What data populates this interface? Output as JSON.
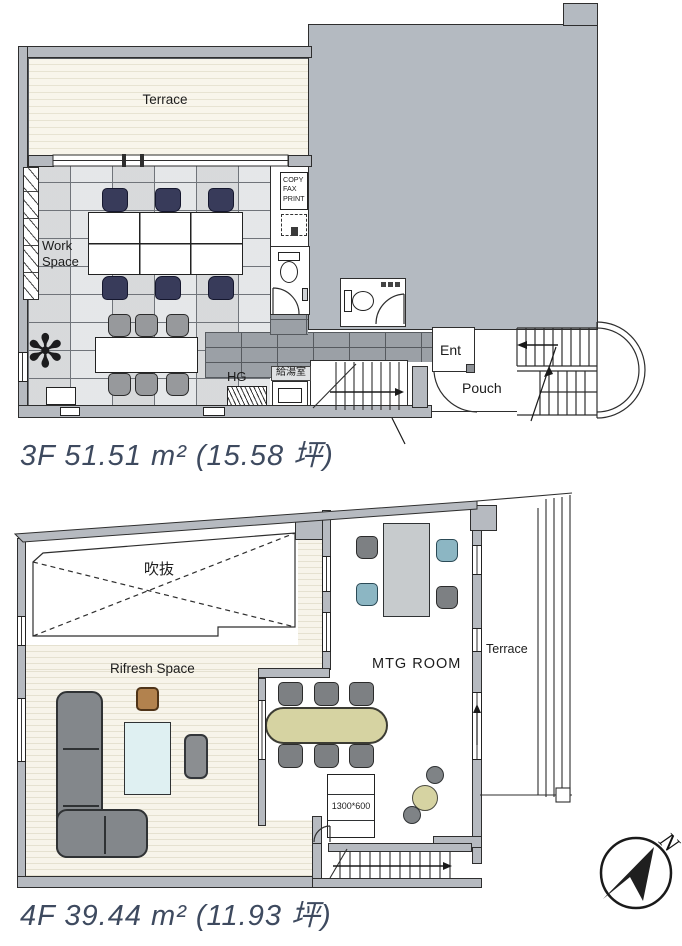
{
  "floor_3f": {
    "area_label": "3F 51.51 m² (15.58 坪)",
    "terrace_label": "Terrace",
    "work_space_label": "Work\nSpace",
    "copy_label": "COPY\nFAX\nPRINT",
    "hg_label": "HG",
    "kitchenette_label": "給湯室",
    "entrance_label": "Ent",
    "porch_label": "Pouch"
  },
  "floor_4f": {
    "area_label": "4F 39.44 m² (11.93 坪)",
    "void_label": "吹抜",
    "refresh_space_label": "Rifresh Space",
    "meeting_room_label": "MTG ROOM",
    "terrace_label": "Terrace",
    "shelf_size_label": "1300*600"
  },
  "compass": {
    "label": "N"
  },
  "colors": {
    "neighbor_mass": "#b4bac1",
    "wall": "#b6bac0",
    "navy_chair": "#383b5a",
    "blue_chair": "#8cb6c3",
    "olive_table": "#d6d3a2",
    "area_text": "#3e4a5f"
  }
}
